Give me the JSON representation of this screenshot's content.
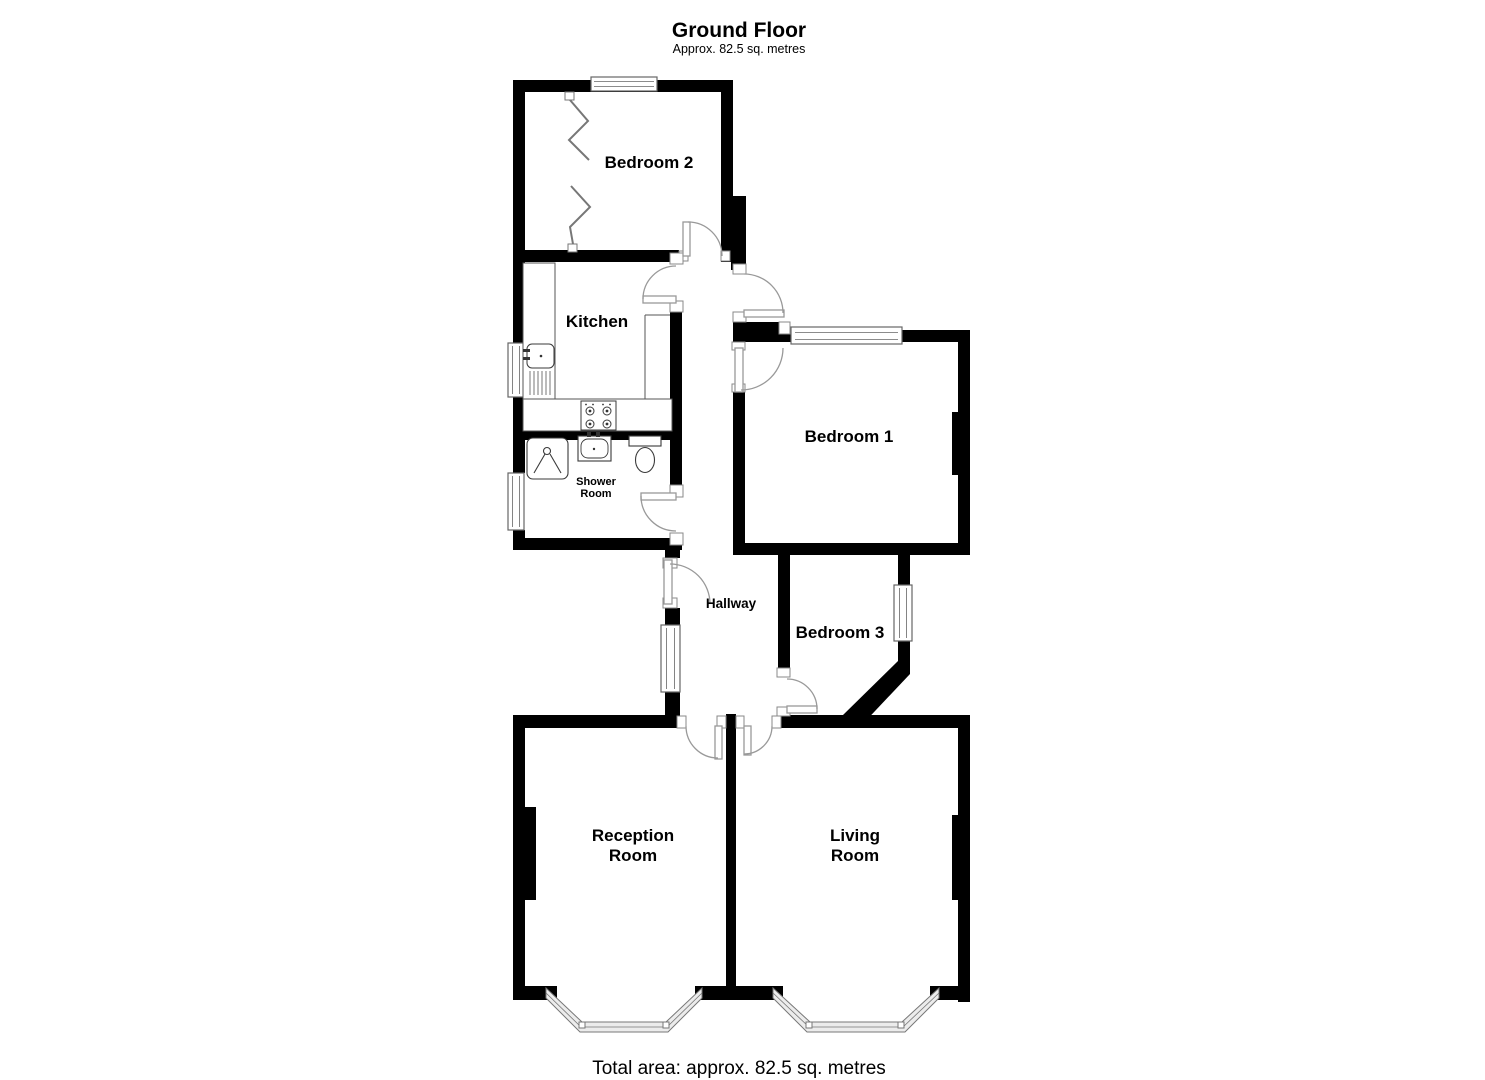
{
  "title": {
    "main": "Ground Floor",
    "sub": "Approx. 82.5 sq. metres"
  },
  "footer": {
    "total": "Total area: approx. 82.5 sq. metres"
  },
  "rooms": {
    "bedroom2": {
      "label": "Bedroom 2"
    },
    "kitchen": {
      "label": "Kitchen"
    },
    "shower": {
      "line1": "Shower",
      "line2": "Room"
    },
    "bedroom1": {
      "label": "Bedroom 1"
    },
    "hallway": {
      "label": "Hallway"
    },
    "bedroom3": {
      "label": "Bedroom 3"
    },
    "reception": {
      "line1": "Reception",
      "line2": "Room"
    },
    "living": {
      "line1": "Living",
      "line2": "Room"
    }
  },
  "fixtures": {
    "sink": "kitchen-sink",
    "drainer": "drainer",
    "hob": "hob-4-burner",
    "shower_tray": "shower-tray",
    "basin": "wash-basin",
    "toilet": "toilet"
  },
  "colors": {
    "wall": "#000000",
    "background": "#ffffff",
    "door_line": "#999999",
    "window_line": "#666666",
    "fixture_line": "#3a3a3a",
    "bay_fill": "#ececec"
  }
}
